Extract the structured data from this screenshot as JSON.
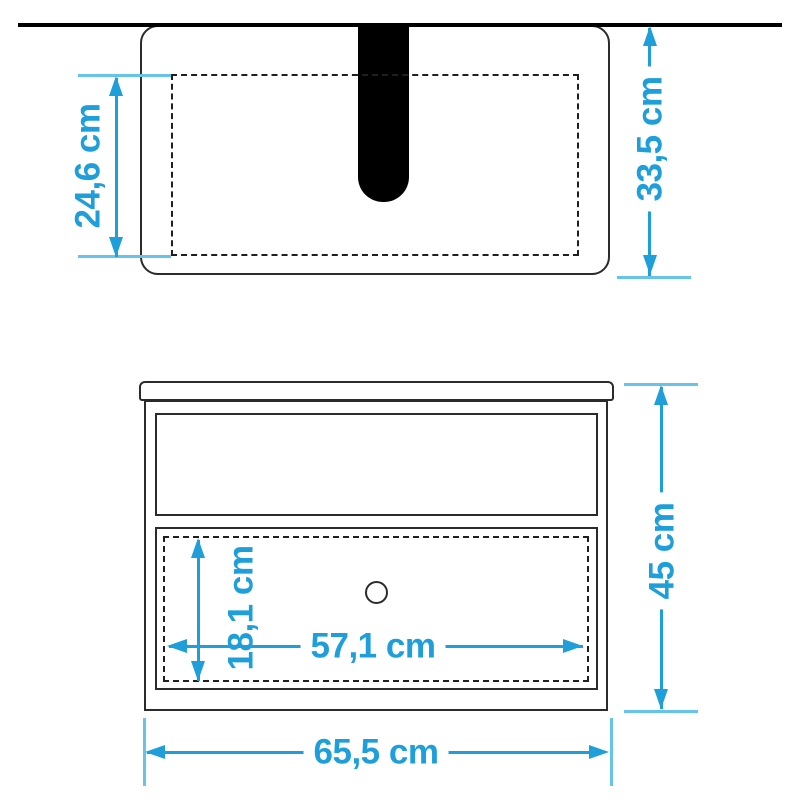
{
  "colors": {
    "dimension_accent": "#1E9FD9",
    "extension_line": "#66C4E9",
    "outline": "#2B2B2B",
    "slot_fill": "#000000",
    "background": "#FFFFFF"
  },
  "diagram": {
    "type": "furniture-dimension-drawing",
    "views": [
      "top-view",
      "front-view"
    ],
    "dims": {
      "top_inner_depth": {
        "label": "24,6 cm",
        "value": 24.6,
        "unit": "cm",
        "orientation": "vertical",
        "view": "top"
      },
      "top_total_depth": {
        "label": "33,5 cm",
        "value": 33.5,
        "unit": "cm",
        "orientation": "vertical",
        "view": "top"
      },
      "drawer_inner_height": {
        "label": "18,1 cm",
        "value": 18.1,
        "unit": "cm",
        "orientation": "vertical",
        "view": "front"
      },
      "drawer_inner_width": {
        "label": "57,1 cm",
        "value": 57.1,
        "unit": "cm",
        "orientation": "horizontal",
        "view": "front"
      },
      "front_total_height": {
        "label": "45 cm",
        "value": 45,
        "unit": "cm",
        "orientation": "vertical",
        "view": "front"
      },
      "front_total_width": {
        "label": "65,5 cm",
        "value": 65.5,
        "unit": "cm",
        "orientation": "horizontal",
        "view": "front"
      }
    }
  }
}
